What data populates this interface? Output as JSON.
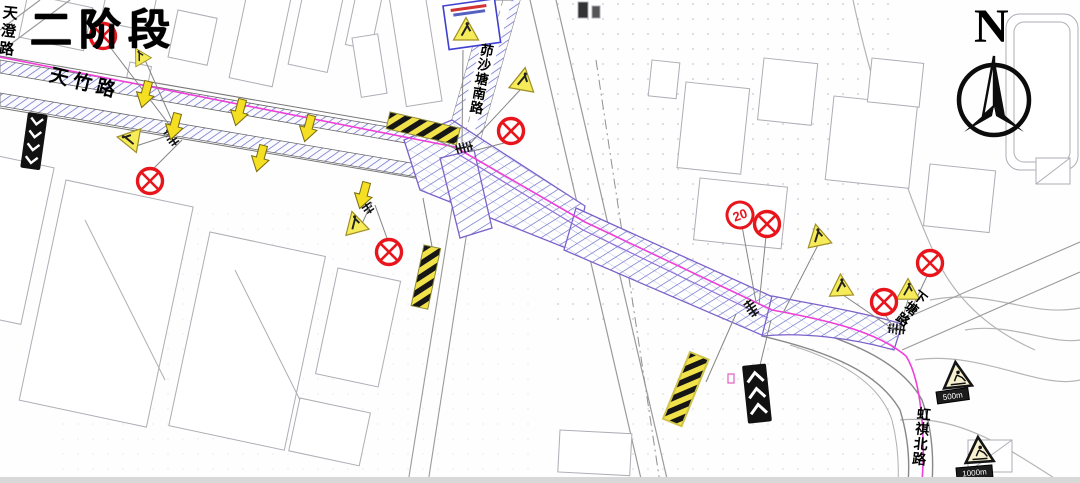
{
  "phase_label": "二阶段",
  "compass_label": "N",
  "roads": {
    "tiancheng": "天澄路",
    "tianzhu": "天竹路",
    "maoshatang_south": "茆沙塘南路",
    "xiatang": "下塘路",
    "hongqi_north": "虹祺北路"
  },
  "signs": {
    "speed_limit": "20",
    "distance_plate_near": "500m",
    "distance_plate_far": "1000m"
  },
  "legend_colors": {
    "prohibition_red": "#e8161c",
    "warning_yellow": "#f6ec5a",
    "construction_hatch_blue": "#5f68c4",
    "route_magenta": "#ee3fd8",
    "map_line_gray": "#a7a7ad"
  }
}
